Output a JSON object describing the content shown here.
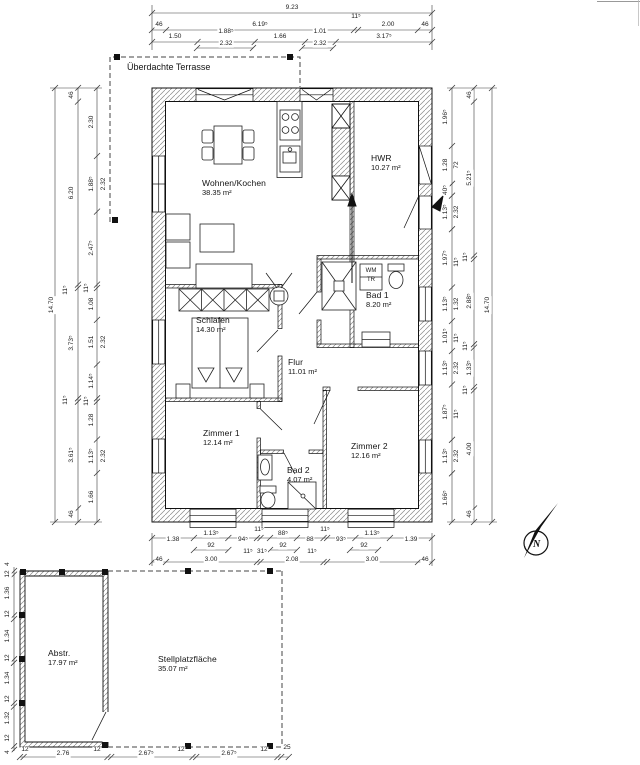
{
  "title": "Grundriss / floor plan drawing",
  "terrace": {
    "label": "Überdachte Terrasse"
  },
  "compass": {
    "label": "N"
  },
  "rooms": [
    {
      "name": "Wohnen/Kochen",
      "area": "38.35 m²",
      "x": 202,
      "y": 178
    },
    {
      "name": "HWR",
      "area": "10.27 m²",
      "x": 371,
      "y": 153
    },
    {
      "name": "Bad 1",
      "area": "8.20 m²",
      "x": 366,
      "y": 290
    },
    {
      "name": "Schlafen",
      "area": "14.30 m²",
      "x": 196,
      "y": 315
    },
    {
      "name": "Flur",
      "area": "11.01 m²",
      "x": 288,
      "y": 357
    },
    {
      "name": "Zimmer 1",
      "area": "12.14 m²",
      "x": 203,
      "y": 428
    },
    {
      "name": "Bad 2",
      "area": "4.07 m²",
      "x": 287,
      "y": 465
    },
    {
      "name": "Zimmer 2",
      "area": "12.16 m²",
      "x": 351,
      "y": 441
    },
    {
      "name": "Abstr.",
      "area": "17.97 m²",
      "x": 48,
      "y": 648
    },
    {
      "name": "Stellplatzfläche",
      "area": "35.07 m²",
      "x": 158,
      "y": 654
    }
  ],
  "fixtures": [
    {
      "t": "WM",
      "x": 371,
      "y": 271
    },
    {
      "t": "TR",
      "x": 371,
      "y": 280
    }
  ],
  "dims_h": [
    {
      "t": "9.23",
      "x": 292,
      "y": 8
    },
    {
      "t": "46",
      "x": 159,
      "y": 25
    },
    {
      "t": "6.19⁵",
      "x": 260,
      "y": 25
    },
    {
      "t": "11⁵",
      "x": 356,
      "y": 17
    },
    {
      "t": "2.00",
      "x": 388,
      "y": 25
    },
    {
      "t": "46",
      "x": 425,
      "y": 25
    },
    {
      "t": "1.50",
      "x": 175,
      "y": 37
    },
    {
      "t": "1.88⁵",
      "x": 226,
      "y": 32
    },
    {
      "t": "1.66",
      "x": 280,
      "y": 37
    },
    {
      "t": "1.01",
      "x": 320,
      "y": 32
    },
    {
      "t": "3.17⁵",
      "x": 384,
      "y": 37
    },
    {
      "t": "2.32",
      "x": 226,
      "y": 44
    },
    {
      "t": "2.32",
      "x": 320,
      "y": 44
    },
    {
      "t": "1.38",
      "x": 173,
      "y": 540
    },
    {
      "t": "1.13⁵",
      "x": 211,
      "y": 534
    },
    {
      "t": "94⁵",
      "x": 243,
      "y": 540
    },
    {
      "t": "11⁵",
      "x": 259,
      "y": 530
    },
    {
      "t": "88⁵",
      "x": 283,
      "y": 534
    },
    {
      "t": "88",
      "x": 310,
      "y": 540
    },
    {
      "t": "11⁵",
      "x": 325,
      "y": 530
    },
    {
      "t": "93⁵",
      "x": 341,
      "y": 540
    },
    {
      "t": "1.13⁵",
      "x": 372,
      "y": 534
    },
    {
      "t": "1.39",
      "x": 411,
      "y": 540
    },
    {
      "t": "92",
      "x": 211,
      "y": 546
    },
    {
      "t": "11⁵",
      "x": 248,
      "y": 552
    },
    {
      "t": "31⁵",
      "x": 262,
      "y": 552
    },
    {
      "t": "92",
      "x": 283,
      "y": 546
    },
    {
      "t": "11⁵",
      "x": 312,
      "y": 552
    },
    {
      "t": "92",
      "x": 364,
      "y": 546
    },
    {
      "t": "46",
      "x": 159,
      "y": 560
    },
    {
      "t": "3.00",
      "x": 211,
      "y": 560
    },
    {
      "t": "2.08",
      "x": 292,
      "y": 560
    },
    {
      "t": "3.00",
      "x": 372,
      "y": 560
    },
    {
      "t": "46",
      "x": 425,
      "y": 560
    },
    {
      "t": "12",
      "x": 25,
      "y": 750
    },
    {
      "t": "2.76",
      "x": 63,
      "y": 754
    },
    {
      "t": "12",
      "x": 97,
      "y": 750
    },
    {
      "t": "2.67⁵",
      "x": 146,
      "y": 754
    },
    {
      "t": "12",
      "x": 181,
      "y": 750
    },
    {
      "t": "2.67⁵",
      "x": 229,
      "y": 754
    },
    {
      "t": "12",
      "x": 264,
      "y": 750
    },
    {
      "t": "25",
      "x": 287,
      "y": 748
    }
  ],
  "dims_v": [
    {
      "t": "14.70",
      "x": 52,
      "y": 305
    },
    {
      "t": "46",
      "x": 72,
      "y": 95
    },
    {
      "t": "6.20",
      "x": 72,
      "y": 193
    },
    {
      "t": "11⁵",
      "x": 66,
      "y": 290
    },
    {
      "t": "3.73⁵",
      "x": 72,
      "y": 343
    },
    {
      "t": "11⁵",
      "x": 66,
      "y": 400
    },
    {
      "t": "3.61⁵",
      "x": 72,
      "y": 455
    },
    {
      "t": "46",
      "x": 72,
      "y": 514
    },
    {
      "t": "2.30",
      "x": 92,
      "y": 122
    },
    {
      "t": "1.88⁵",
      "x": 92,
      "y": 184
    },
    {
      "t": "2.47⁵",
      "x": 92,
      "y": 248
    },
    {
      "t": "11⁵",
      "x": 87,
      "y": 288
    },
    {
      "t": "1.08",
      "x": 92,
      "y": 304
    },
    {
      "t": "1.51",
      "x": 92,
      "y": 342
    },
    {
      "t": "1.14⁵",
      "x": 92,
      "y": 381
    },
    {
      "t": "11⁵",
      "x": 87,
      "y": 401
    },
    {
      "t": "1.28",
      "x": 92,
      "y": 420
    },
    {
      "t": "1.13⁵",
      "x": 92,
      "y": 456
    },
    {
      "t": "1.66",
      "x": 92,
      "y": 497
    },
    {
      "t": "2.32",
      "x": 104,
      "y": 184
    },
    {
      "t": "2.32",
      "x": 104,
      "y": 342
    },
    {
      "t": "2.32",
      "x": 104,
      "y": 456
    },
    {
      "t": "1.96⁵",
      "x": 446,
      "y": 117
    },
    {
      "t": "1.28",
      "x": 446,
      "y": 165
    },
    {
      "t": "40⁵",
      "x": 446,
      "y": 190
    },
    {
      "t": "1.13⁵",
      "x": 446,
      "y": 212
    },
    {
      "t": "1.97⁵",
      "x": 446,
      "y": 258
    },
    {
      "t": "1.13⁵",
      "x": 446,
      "y": 304
    },
    {
      "t": "1.01⁵",
      "x": 446,
      "y": 336
    },
    {
      "t": "1.13⁵",
      "x": 446,
      "y": 368
    },
    {
      "t": "1.87⁵",
      "x": 446,
      "y": 412
    },
    {
      "t": "1.13⁵",
      "x": 446,
      "y": 456
    },
    {
      "t": "1.66⁵",
      "x": 446,
      "y": 498
    },
    {
      "t": "72",
      "x": 457,
      "y": 165
    },
    {
      "t": "2.32",
      "x": 457,
      "y": 212
    },
    {
      "t": "11⁵",
      "x": 457,
      "y": 262
    },
    {
      "t": "1.32",
      "x": 457,
      "y": 304
    },
    {
      "t": "11⁵",
      "x": 457,
      "y": 338
    },
    {
      "t": "2.32",
      "x": 457,
      "y": 368
    },
    {
      "t": "11⁵",
      "x": 457,
      "y": 414
    },
    {
      "t": "2.32",
      "x": 457,
      "y": 456
    },
    {
      "t": "46",
      "x": 470,
      "y": 95
    },
    {
      "t": "5.21⁵",
      "x": 470,
      "y": 178
    },
    {
      "t": "11⁵",
      "x": 466,
      "y": 257
    },
    {
      "t": "2.88⁵",
      "x": 470,
      "y": 301
    },
    {
      "t": "11⁵",
      "x": 466,
      "y": 346
    },
    {
      "t": "1.33⁵",
      "x": 470,
      "y": 368
    },
    {
      "t": "11⁵",
      "x": 466,
      "y": 390
    },
    {
      "t": "4.00",
      "x": 470,
      "y": 449
    },
    {
      "t": "46",
      "x": 470,
      "y": 514
    },
    {
      "t": "14.70",
      "x": 488,
      "y": 305
    },
    {
      "t": "4",
      "x": 8,
      "y": 564
    },
    {
      "t": "12",
      "x": 8,
      "y": 574
    },
    {
      "t": "1.36",
      "x": 8,
      "y": 593
    },
    {
      "t": "12",
      "x": 8,
      "y": 614
    },
    {
      "t": "1.34",
      "x": 8,
      "y": 636
    },
    {
      "t": "12",
      "x": 8,
      "y": 658
    },
    {
      "t": "1.34",
      "x": 8,
      "y": 678
    },
    {
      "t": "12",
      "x": 8,
      "y": 699
    },
    {
      "t": "1.32",
      "x": 8,
      "y": 718
    },
    {
      "t": "12",
      "x": 8,
      "y": 738
    },
    {
      "t": "4",
      "x": 8,
      "y": 752
    }
  ],
  "colors": {
    "line": "#1a1a1a",
    "dim_line": "#3a3a3a",
    "hatch": "#8a8a8a"
  }
}
